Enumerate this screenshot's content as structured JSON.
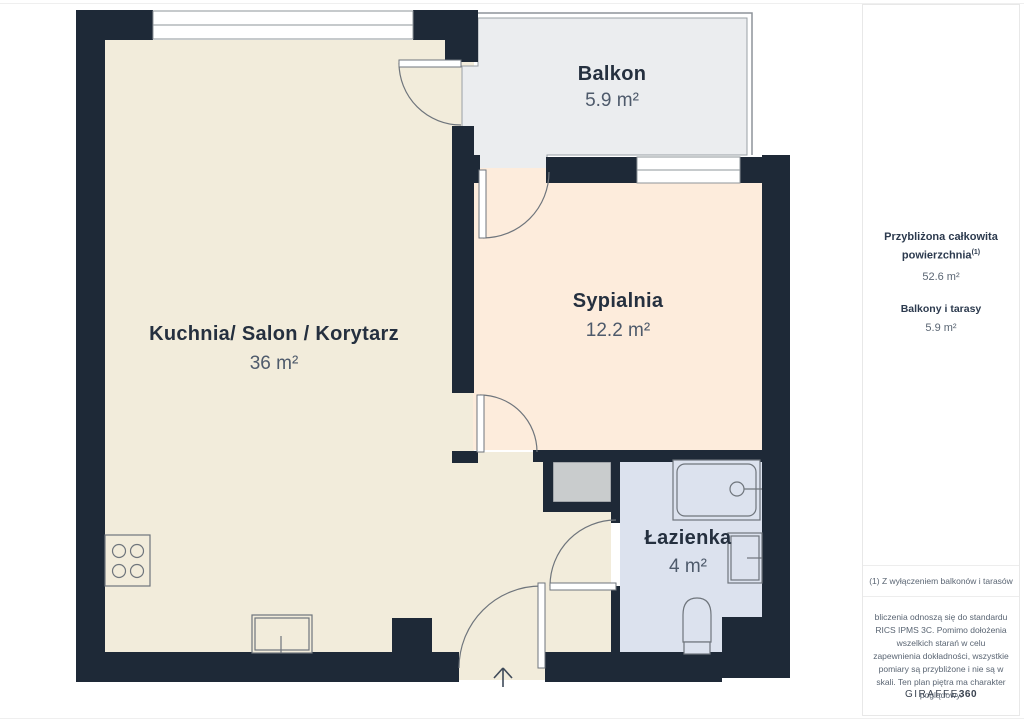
{
  "plan": {
    "rooms": [
      {
        "id": "balkon",
        "name": "Balkon",
        "area": "5.9 m²"
      },
      {
        "id": "kuchnia",
        "name": "Kuchnia/ Salon / Korytarz",
        "area": "36 m²"
      },
      {
        "id": "sypialnia",
        "name": "Sypialnia",
        "area": "12.2 m²"
      },
      {
        "id": "lazienka",
        "name": "Łazienka",
        "area": "4 m²"
      }
    ],
    "colors": {
      "wall": "#1e2937",
      "floor_main": "#f2ecdb",
      "floor_bedroom": "#fdecdc",
      "floor_balcony": "#ebedef",
      "floor_bathroom": "#dce2ee",
      "shower": "#c9cccd",
      "thin_line": "#8e949a",
      "fixture_line": "#6f757c",
      "label_dark": "#25303f",
      "label_value": "#4e5a6b"
    }
  },
  "sidebar": {
    "total_label": "Przybliżona całkowita powierzchnia",
    "total_sup": "(1)",
    "total_value": "52.6 m²",
    "balconies_label": "Balkony i tarasy",
    "balconies_value": "5.9 m²",
    "footnote": "(1) Z wyłączeniem balkonów i tarasów",
    "disclaimer": "bliczenia odnoszą się do standardu RICS IPMS 3C. Pomimo dołożenia wszelkich starań w celu zapewnienia dokładności, wszystkie pomiary są przybliżone i nie są w skali. Ten plan piętra ma charakter poglądowy.",
    "brand": {
      "name": "GIRAFFE",
      "suffix": "360"
    }
  }
}
